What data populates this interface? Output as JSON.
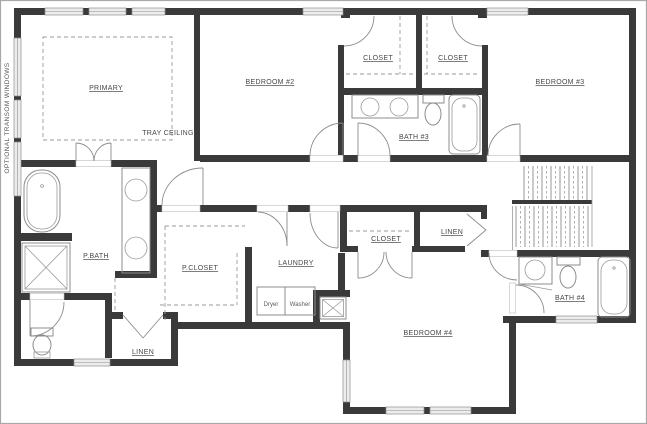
{
  "note_vertical": "OPTIONAL TRANSOM WINDOWS",
  "rooms": {
    "primary": "PRIMARY",
    "tray_ceiling": "TRAY CEILING",
    "bedroom2": "BEDROOM #2",
    "bedroom3": "BEDROOM #3",
    "bedroom4": "BEDROOM #4",
    "bath3": "BATH #3",
    "bath4": "BATH #4",
    "pbath": "P.BATH",
    "pcloset": "P.CLOSET",
    "laundry": "LAUNDRY",
    "closet_b2": "CLOSET",
    "closet_b3": "CLOSET",
    "closet_b4": "CLOSET",
    "linen_hall": "LINEN",
    "linen_suite": "LINEN"
  },
  "appliances": {
    "dryer": "Dryer",
    "washer": "Washer"
  },
  "colors": {
    "wall": "#3a3a3a",
    "fixture_line": "#8c8c8c",
    "window_fill": "#ececec",
    "text": "#474747",
    "background": "#ffffff",
    "border": "#a8a8a8"
  }
}
